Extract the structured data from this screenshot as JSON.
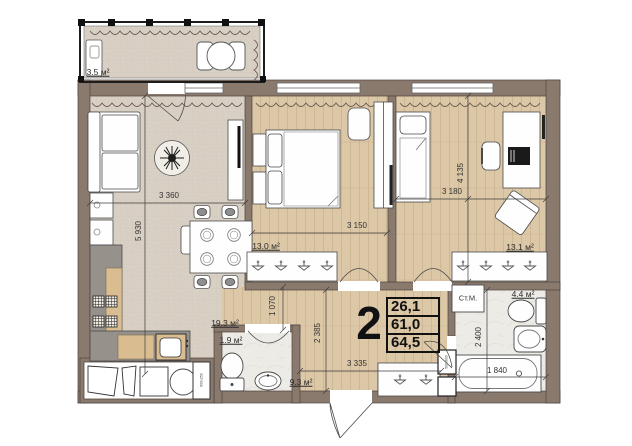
{
  "badge": {
    "room_count": "2",
    "row1": "26,1",
    "row2": "61,0",
    "row3": "64,5"
  },
  "areas": {
    "balcony": "3.5 м²",
    "kitchen_living": "19.3 м²",
    "bedroom1": "13.0 м²",
    "bedroom2": "13.1 м²",
    "wc": "1.9 м²",
    "hallway": "9.3 м²",
    "bathroom": "4.4 м²"
  },
  "dims": {
    "living_width": "3 360",
    "living_length": "5 930",
    "bedroom1_width": "3 150",
    "bedroom2_width": "3 180",
    "bedroom2_length": "4 135",
    "passage_width": "1 070",
    "hallway_length": "2 385",
    "hallway_width": "3 335",
    "bathroom_length": "2 400",
    "bathtub_length": "1 840"
  },
  "labels": {
    "washing_machine": "Ст.М.",
    "shaft_kitchen": "600x250",
    "shaft_bath": "500x600"
  },
  "colors": {
    "wall": "#8a7a6d",
    "floor_tile": "#d9d0c5",
    "floor_wood": "#dcc7a7",
    "floor_stone": "#edebe6",
    "counter": "#96918b",
    "wood_accent": "#d9bd90",
    "line": "#3d3d3d"
  }
}
